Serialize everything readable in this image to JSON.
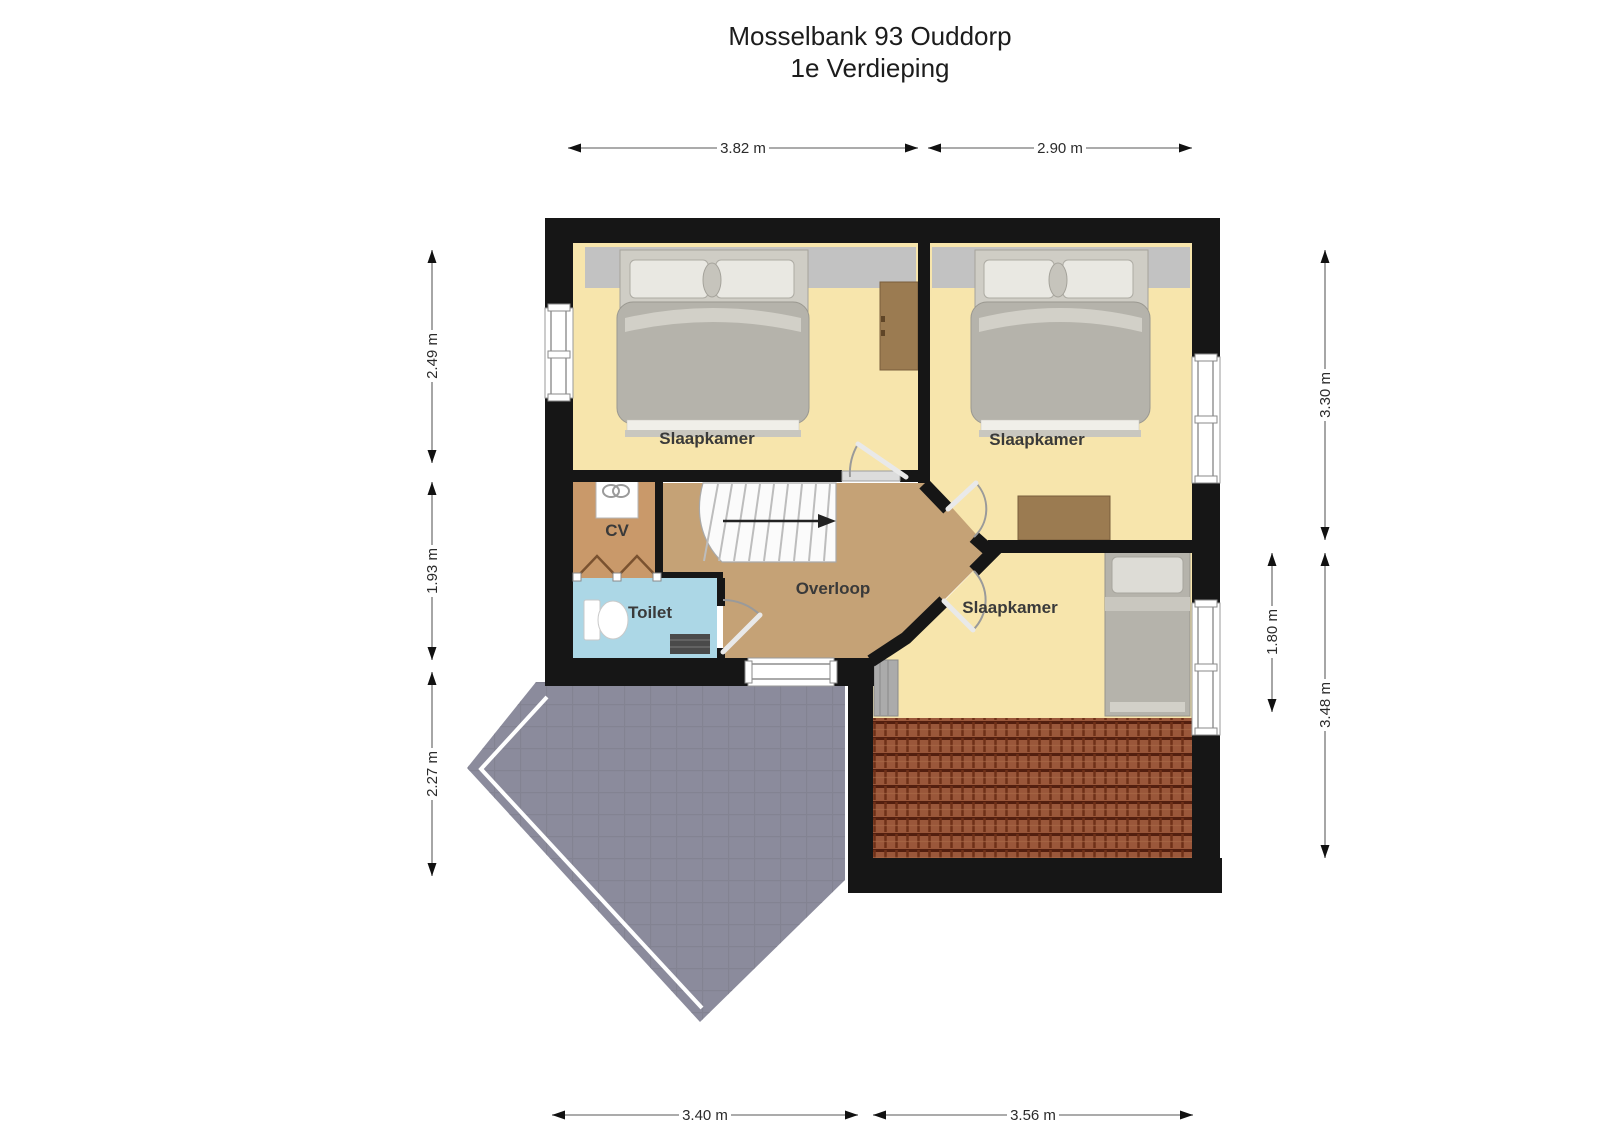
{
  "title": {
    "line1": "Mosselbank 93 Ouddorp",
    "line2": "1e Verdieping"
  },
  "rooms": {
    "bedroom_top_left": {
      "label": "Slaapkamer"
    },
    "bedroom_top_right": {
      "label": "Slaapkamer"
    },
    "bedroom_bottom_right": {
      "label": "Slaapkamer"
    },
    "cv_closet": {
      "label": "CV"
    },
    "toilet": {
      "label": "Toilet"
    },
    "landing": {
      "label": "Overloop"
    }
  },
  "dimensions": {
    "top_width_left": "3.82 m",
    "top_width_right": "2.90 m",
    "bottom_width_left": "3.40 m",
    "bottom_width_right": "3.56 m",
    "left_height_top": "2.49 m",
    "left_height_middle": "1.93 m",
    "left_height_bottom": "2.27 m",
    "right_height_top": "3.30 m",
    "right_height_bottom": "3.48 m",
    "right_height_inner": "1.80 m"
  },
  "colors": {
    "wall": "#161616",
    "bedroom_floor": "#F7E5AC",
    "landing_floor": "#C5A276",
    "cv_floor": "#C9996A",
    "toilet_floor": "#ACD7E6",
    "balcony": "#8B8B9C",
    "roof_tiles": "#9A573A",
    "roof_slope_band": "#C2C2C2",
    "stairs": "#FBFBFB",
    "furniture_gray": "#B5B3AB",
    "desk_brown": "#9B7B51"
  }
}
